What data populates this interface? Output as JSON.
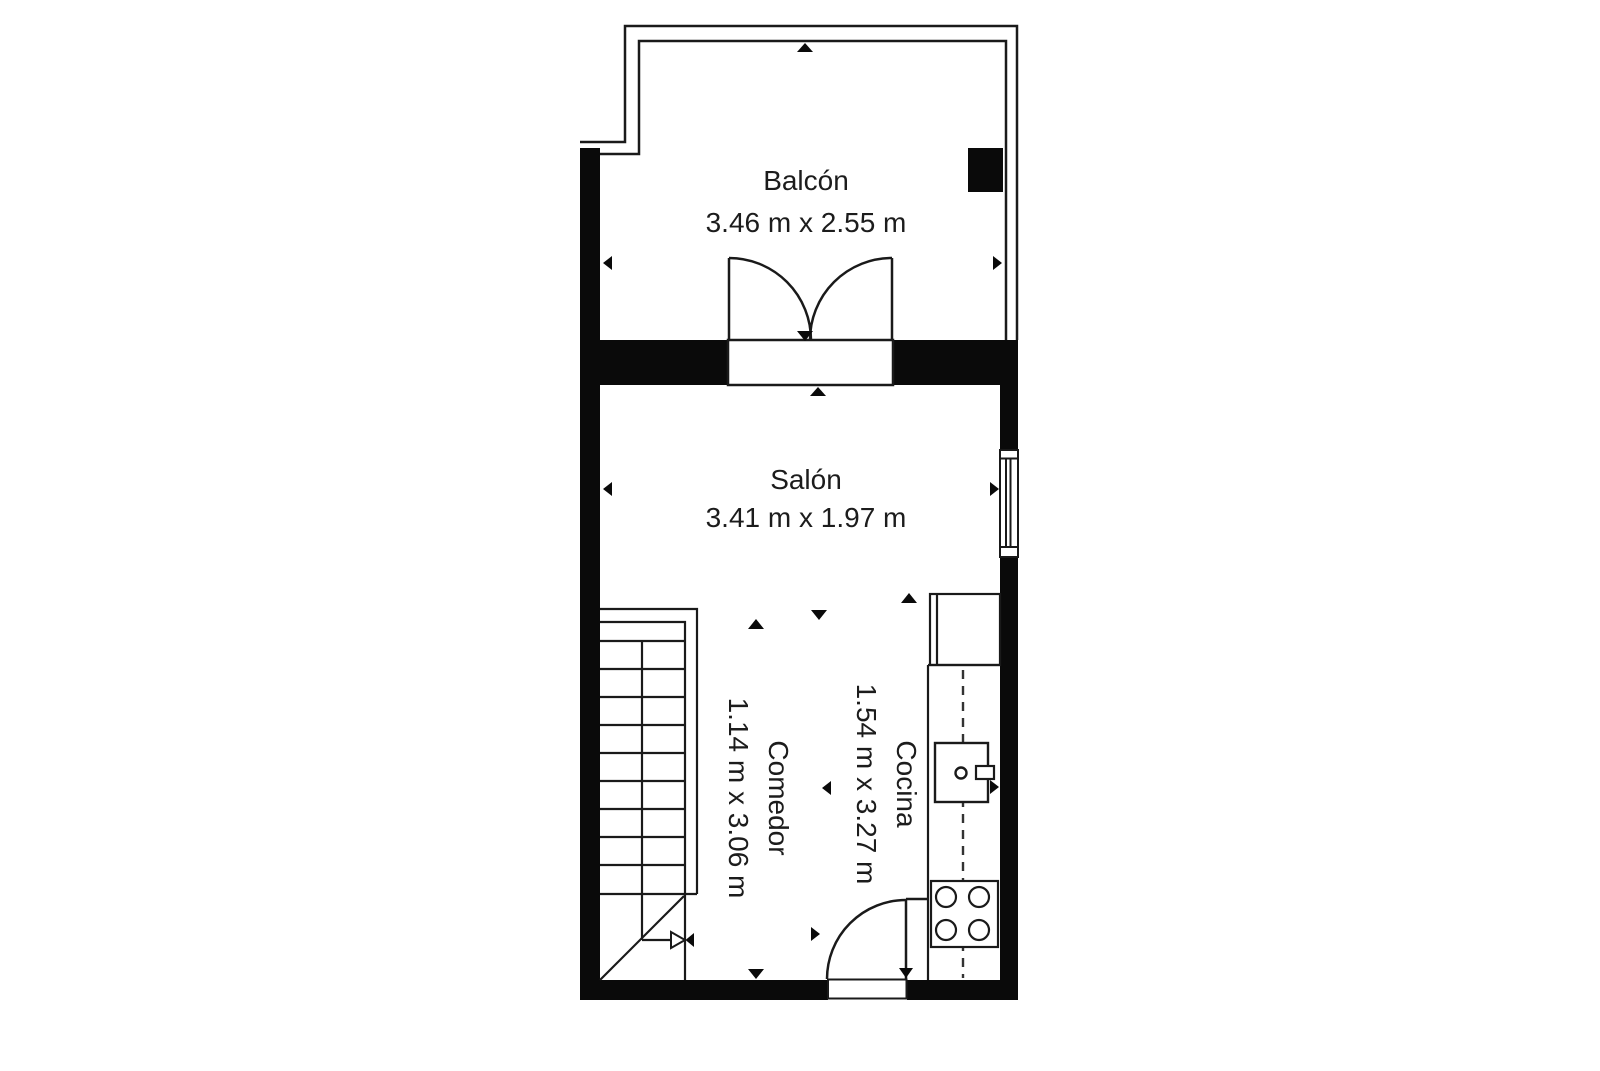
{
  "floor_plan": {
    "background_color": "#ffffff",
    "wall_color": "#0a0a0a",
    "line_color": "#1a1a1a",
    "text_color": "#1c1c1c",
    "rooms": [
      {
        "name": "Balcón",
        "dimensions": "3.46 m x 2.55 m",
        "orientation": "horizontal"
      },
      {
        "name": "Salón",
        "dimensions": "3.41 m x 1.97 m",
        "orientation": "horizontal"
      },
      {
        "name": "Comedor",
        "dimensions": "1.14 m x 3.06 m",
        "orientation": "vertical"
      },
      {
        "name": "Cocina",
        "dimensions": "1.54 m x 3.27 m",
        "orientation": "vertical"
      }
    ],
    "features": [
      "balcony-railing",
      "structural-pillar",
      "double-french-door",
      "window",
      "staircase-with-direction-arrow",
      "entry-door",
      "kitchen-cabinet",
      "kitchen-sink",
      "stove-4-burners",
      "compass-tick-markers"
    ]
  }
}
